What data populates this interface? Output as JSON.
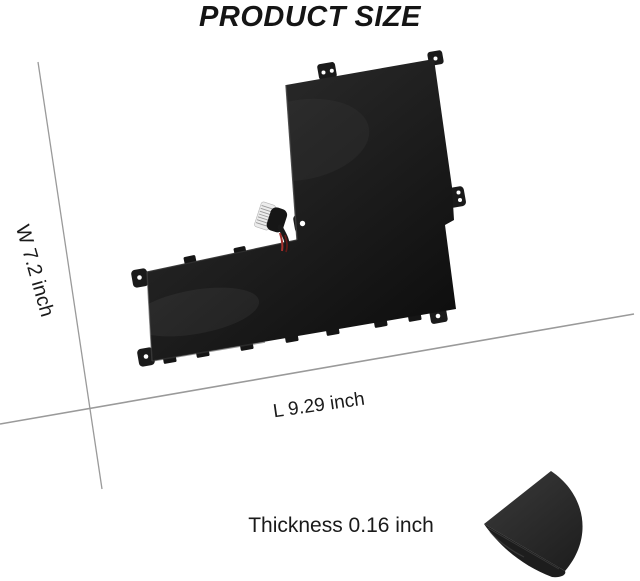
{
  "title": "PRODUCT SIZE",
  "dimensions": {
    "width": "W 7.2 inch",
    "length": "L 9.29 inch",
    "thickness": "Thickness 0.16 inch"
  },
  "colors": {
    "background": "#ffffff",
    "text": "#1a1a1a",
    "dimension_line": "#9a9a9a",
    "battery_dark": "#0d0d0d",
    "battery_light": "#272727",
    "connector_white": "#ececec",
    "wire_red": "#a5302c",
    "wedge_light": "#363636",
    "wedge_dark": "#1d1d1d"
  }
}
